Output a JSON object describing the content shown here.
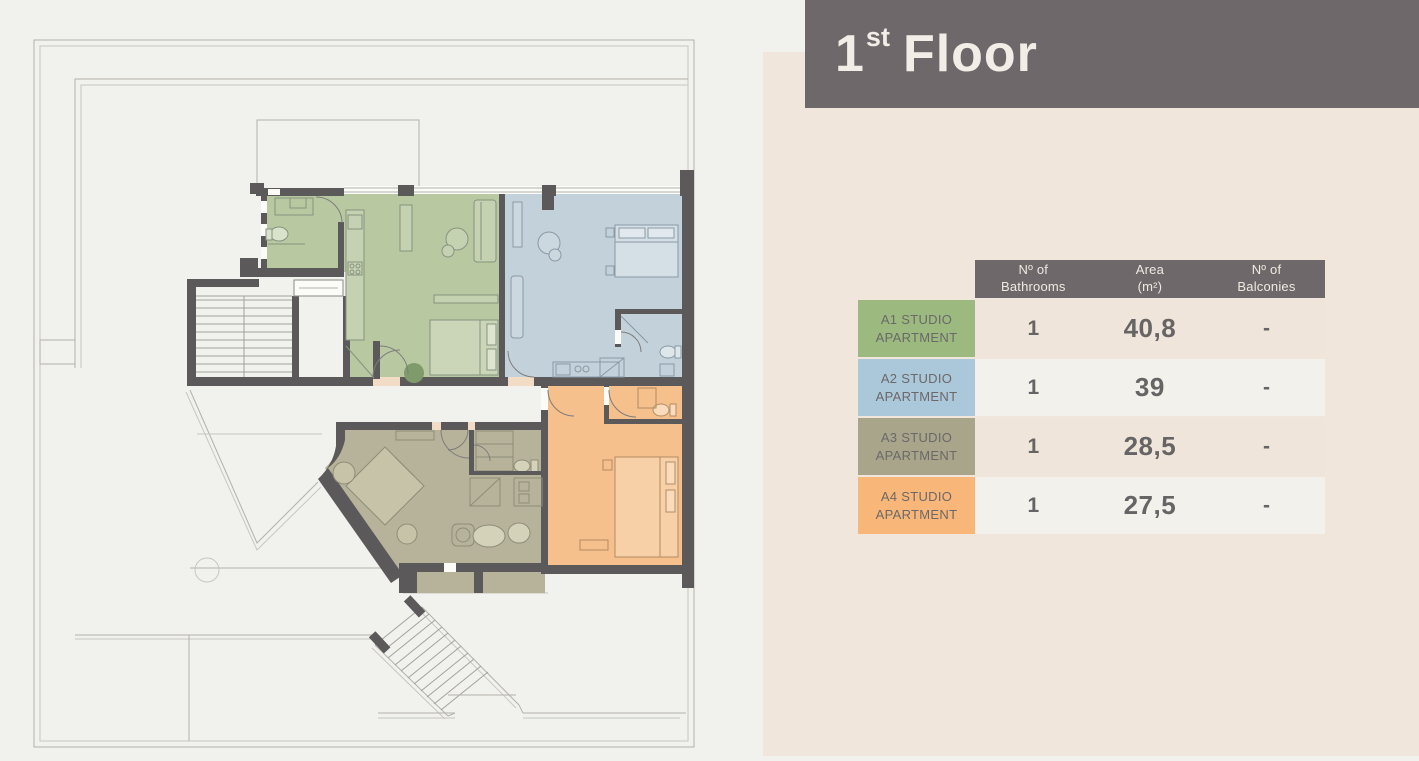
{
  "page": {
    "background_left": "#f1f1ed",
    "background_panel": "#f0e6dc"
  },
  "header": {
    "title_number": "1",
    "title_suffix": "st",
    "title_rest": "Floor",
    "banner_color": "#6f686a",
    "text_color": "#f3ede7"
  },
  "table": {
    "header_bg": "#6f686a",
    "headers": [
      {
        "line1": "Nº of",
        "line2": "Bathrooms"
      },
      {
        "line1": "Area",
        "line2": "(m²)"
      },
      {
        "line1": "Nº of",
        "line2": "Balconies"
      }
    ],
    "rows": [
      {
        "label_line1": "A1 STUDIO",
        "label_line2": "APARTMENT",
        "label_color": "#9cba80",
        "bathrooms": "1",
        "area": "40,8",
        "balconies": "-"
      },
      {
        "label_line1": "A2 STUDIO",
        "label_line2": "APARTMENT",
        "label_color": "#abc8da",
        "bathrooms": "1",
        "area": "39",
        "balconies": "-"
      },
      {
        "label_line1": "A3 STUDIO",
        "label_line2": "APARTMENT",
        "label_color": "#a8a58b",
        "bathrooms": "1",
        "area": "28,5",
        "balconies": "-"
      },
      {
        "label_line1": "A4 STUDIO",
        "label_line2": "APARTMENT",
        "label_color": "#f8b778",
        "bathrooms": "1",
        "area": "27,5",
        "balconies": "-"
      }
    ]
  },
  "floorplan": {
    "wall_color": "#5c595b",
    "units": [
      {
        "id": "A1",
        "name": "A1 Studio Apartment",
        "color": "#b8c9a2"
      },
      {
        "id": "A2",
        "name": "A2 Studio Apartment",
        "color": "#c3d1db"
      },
      {
        "id": "A3",
        "name": "A3 Studio Apartment",
        "color": "#b6b39a"
      },
      {
        "id": "A4",
        "name": "A4 Studio Apartment",
        "color": "#f5c08c"
      }
    ]
  }
}
